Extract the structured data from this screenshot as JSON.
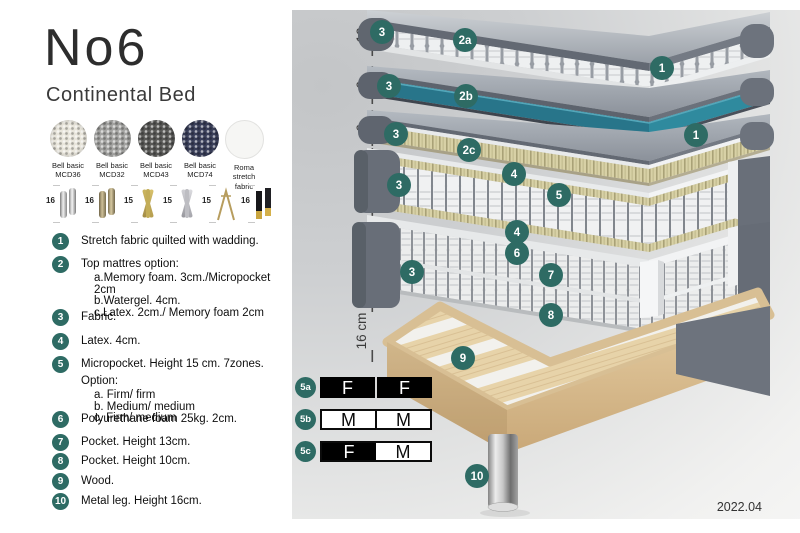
{
  "header": {
    "title": "No6",
    "subtitle": "Continental Bed"
  },
  "swatches": [
    {
      "line1": "Bell basic",
      "line2": "MCD36"
    },
    {
      "line1": "Bell basic",
      "line2": "MCD32"
    },
    {
      "line1": "Bell basic",
      "line2": "MCD43"
    },
    {
      "line1": "Bell basic",
      "line2": "MCD74"
    },
    {
      "line1": "Roma",
      "line2": "stretch fabric"
    }
  ],
  "legs": [
    {
      "size": "16"
    },
    {
      "size": "16"
    },
    {
      "size": "15"
    },
    {
      "size": "15"
    },
    {
      "size": "15"
    },
    {
      "size": "16"
    }
  ],
  "list": [
    {
      "num": "1",
      "text": "Stretch fabric quilted with wadding."
    },
    {
      "num": "2",
      "text": "Top mattres option:",
      "sub": [
        "a.Memory foam. 3cm./Micropocket 2cm",
        "b.Watergel. 4cm.",
        "c.Latex. 2cm./ Memory foam 2cm"
      ]
    },
    {
      "num": "3",
      "text": "Fabric."
    },
    {
      "num": "4",
      "text": "Latex. 4cm."
    },
    {
      "num": "5",
      "text": "Micropocket. Height 15 cm. 7zones. Option:",
      "sub": [
        "a. Firm/ firm",
        "b. Medium/ medium",
        "c. Firm/ medium"
      ]
    },
    {
      "num": "6",
      "text": "Polyurethane foam 25kg. 2cm."
    },
    {
      "num": "7",
      "text": "Pocket. Height 13cm."
    },
    {
      "num": "8",
      "text": "Pocket. Height 10cm."
    },
    {
      "num": "9",
      "text": "Wood."
    },
    {
      "num": "10",
      "text": "Metal leg. Height 16cm."
    }
  ],
  "diagram": {
    "dimensions": [
      "10",
      "6",
      "6",
      "23 cm",
      "27 cm",
      "16 cm"
    ],
    "callouts": [
      "3",
      "2a",
      "1",
      "3",
      "2b",
      "3",
      "2c",
      "1",
      "4",
      "3",
      "5",
      "4",
      "6",
      "3",
      "7",
      "8",
      "9",
      "10"
    ],
    "version": "2022.04"
  },
  "firmness": {
    "rows": [
      {
        "label": "5a",
        "left": "F",
        "right": "F"
      },
      {
        "label": "5b",
        "left": "M",
        "right": "M"
      },
      {
        "label": "5c",
        "left": "F",
        "right": "M"
      }
    ]
  },
  "colors": {
    "accent_teal": "#2E6B64",
    "layer_teal": "#2B7E92",
    "slate": "#6B717B",
    "wood": "#DFC49C",
    "black": "#000000"
  }
}
